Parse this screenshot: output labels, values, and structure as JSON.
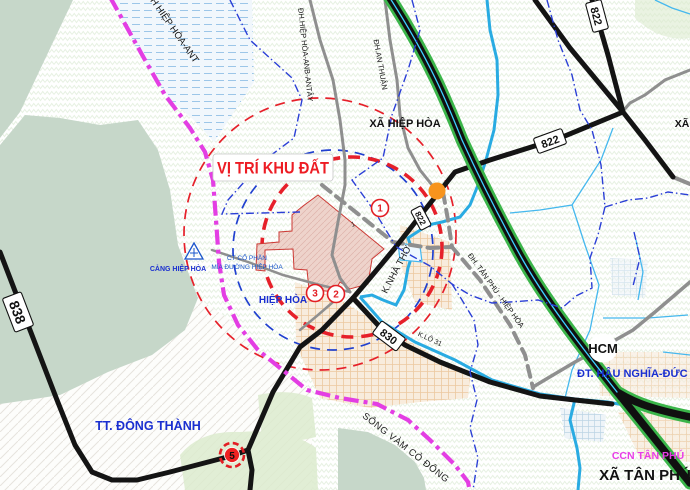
{
  "map": {
    "title_label": "VỊ TRÍ KHU ĐẤT",
    "areas": {
      "xa_hiep_hoa": "XÃ HIỆP HÒA",
      "xa_tan_phu": "XÃ TÂN PHÚ",
      "tt_dong_thanh": "TT. ĐÔNG THÀNH",
      "ccn_tan_phu": "CCN TÂN PHÚ",
      "hiep_hoa": "HIỆP HÒA",
      "xa_edge_right": "XÃ"
    },
    "roads": {
      "r822": "822",
      "r838": "838",
      "r830": "830",
      "hcm_shield": "HCM",
      "dh_hiep_hoa_anb_antay": "ĐH.HIỆP HÒA-ANB-ANTÂY",
      "dh_an_thuan": "ĐH.AN THUẬN",
      "dh_tan_phu_hiep_hoa": "ĐH. TÂN PHÚ - HIỆP HÒA",
      "dt_hau_nghia_duc_hoa": "ĐT. HẬU NGHĨA-ĐỨC HÒA",
      "h_hiep_hoa_ant": "H HIỆP HÒA-ANT"
    },
    "water": {
      "song_vam_co_dong": "SÔNG VÀM CỎ ĐÔNG",
      "k_nha_tho": "K.NHÀ THỜ",
      "k_lo_31": "K.LÔ 31"
    },
    "pois": {
      "cang_hiep_hoa": "CẢNG HIỆP HÒA",
      "ct_co_phan_line1": "CT CỔ PHẦN",
      "ct_co_phan_line2": "MÍA ĐƯỜNG HIỆP HÒA"
    },
    "markers": {
      "m1": "1",
      "m2": "2",
      "m3": "3",
      "m5": "5",
      "plot_tick": "1"
    },
    "colors": {
      "highway_green": "#3bb54a",
      "road_black": "#111111",
      "canal_cyan": "#29abe2",
      "boundary_magenta": "#e33ee3",
      "admin_blue": "#2b3fd6",
      "circle_red": "#e31e24",
      "plot_pink": "#eed3cb",
      "river_sage": "#c6d7c9",
      "label_blue": "#1a2fd0",
      "ccn_magenta": "#e83ee8",
      "orange_dot": "#f7941d"
    }
  }
}
